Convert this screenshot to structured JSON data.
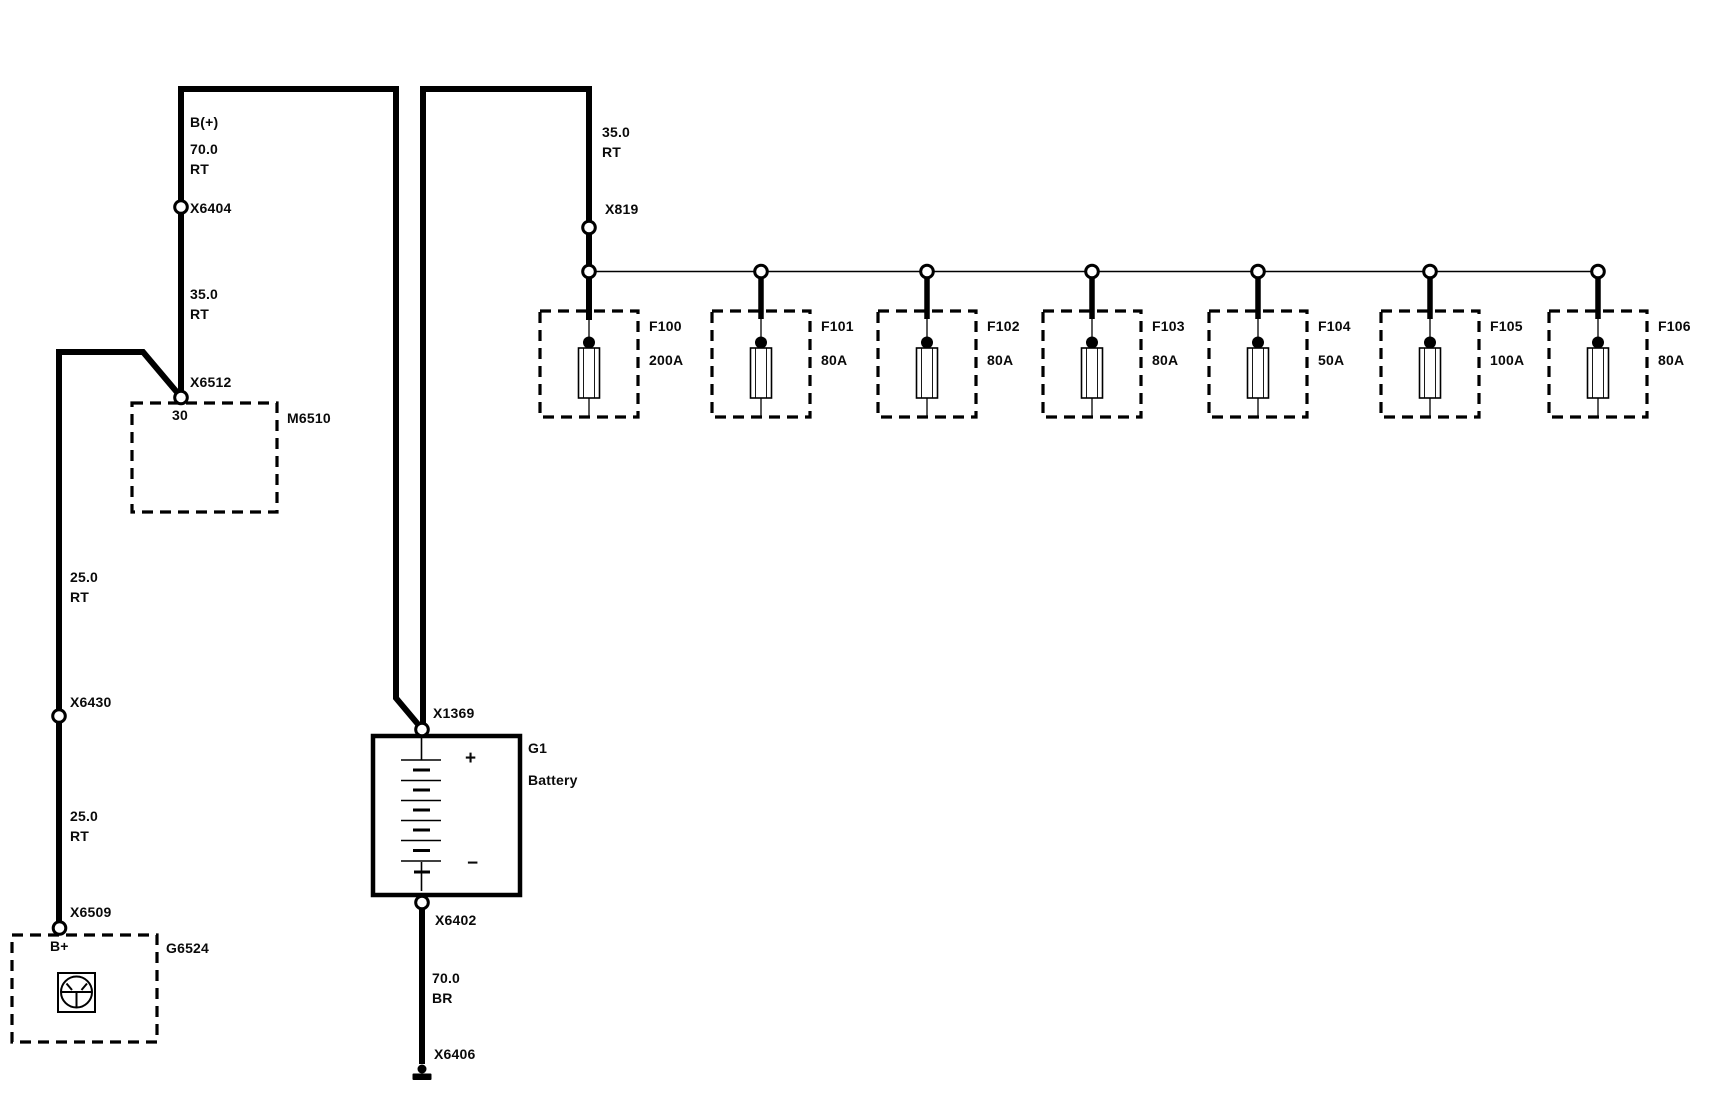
{
  "colors": {
    "line": "#000000",
    "background": "#ffffff"
  },
  "feed_left": {
    "terminal": "B(+)",
    "seg1_size": "70.0",
    "seg1_color": "RT",
    "splice1": "X6404",
    "seg2_size": "35.0",
    "seg2_color": "RT",
    "splice2": "X6512"
  },
  "module": {
    "pin": "30",
    "id": "M6510"
  },
  "ground_feed": {
    "seg1_size": "25.0",
    "seg1_color": "RT",
    "splice1": "X6430",
    "seg2_size": "25.0",
    "seg2_color": "RT",
    "splice2": "X6509",
    "terminal": "B+",
    "id": "G6524"
  },
  "battery": {
    "splice_top": "X1369",
    "id": "G1",
    "name": "Battery",
    "plus": "+",
    "minus": "−",
    "splice_bottom": "X6402",
    "seg_size": "70.0",
    "seg_color": "BR",
    "ground_splice": "X6406"
  },
  "fuse_feed": {
    "seg_size": "35.0",
    "seg_color": "RT",
    "splice": "X819"
  },
  "fuses": [
    {
      "name": "F100",
      "rating": "200A"
    },
    {
      "name": "F101",
      "rating": "80A"
    },
    {
      "name": "F102",
      "rating": "80A"
    },
    {
      "name": "F103",
      "rating": "80A"
    },
    {
      "name": "F104",
      "rating": "50A"
    },
    {
      "name": "F105",
      "rating": "100A"
    },
    {
      "name": "F106",
      "rating": "80A"
    }
  ]
}
